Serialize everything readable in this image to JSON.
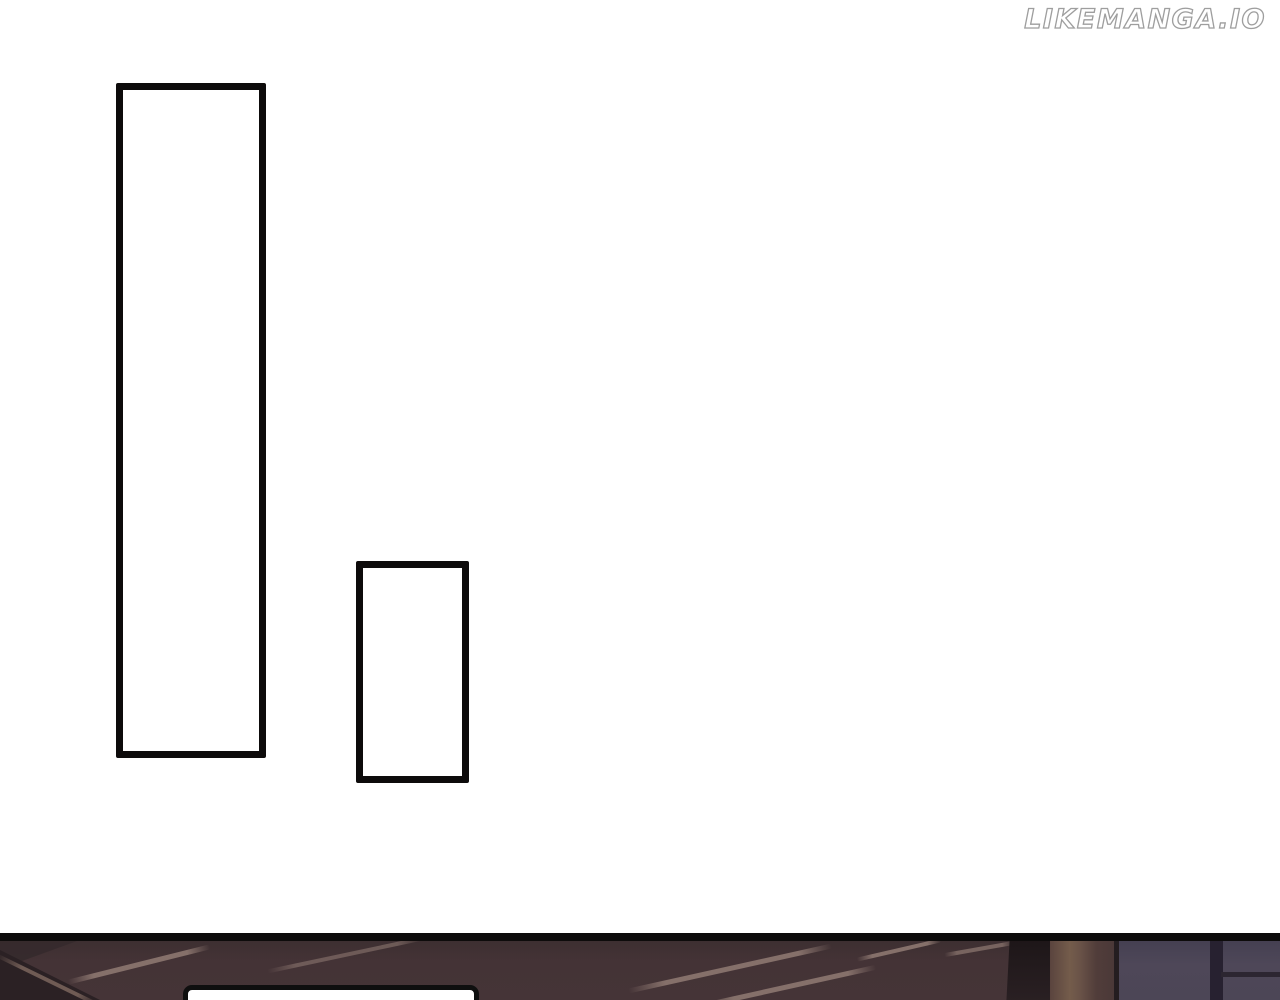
{
  "watermark": {
    "text": "LIKEMANGA.IO"
  },
  "colors": {
    "page_bg": "#ffffff",
    "panel_border": "#0d0b0b",
    "watermark_fill": "#ffffff",
    "watermark_outline": "#9e9e9e",
    "wood_dark": "#443336",
    "wood_shadow": "#2b2124",
    "edge_highlight": "#6f5b54",
    "streak_light": "#85706a",
    "beam_dark": "#1d1618",
    "plank_tan": "#745c4b",
    "plank_brown": "#513d3a",
    "window_slate": "#4e4758",
    "window_frame": "#272130",
    "bubble_fill": "#ffffff",
    "bubble_border": "#0f0f0f"
  }
}
